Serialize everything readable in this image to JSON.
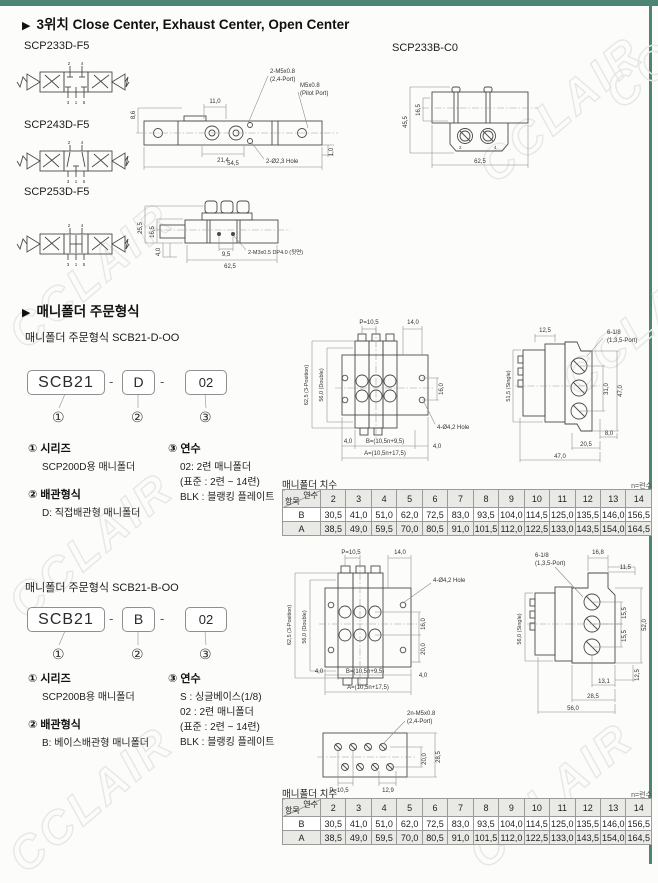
{
  "page": {
    "watermark": "CCLAIR",
    "bullet": "▶"
  },
  "section_valves": {
    "title": "3위치 Close Center, Exhaust Center, Open Center",
    "model_233d": "SCP233D-F5",
    "model_233b": "SCP233B-C0",
    "model_243d": "SCP243D-F5",
    "model_253d": "SCP253D-F5",
    "valve_ports": {
      "p2": "2",
      "p4": "4",
      "p3": "3",
      "p1": "1",
      "p5": "5"
    },
    "dwg233d": {
      "d110": "11,0",
      "d86": "8,6",
      "d214": "21,4",
      "d545": "54,5",
      "d10": "1,0",
      "c1": "2-M5x0.8",
      "c1b": "(2,4-Port)",
      "c2": "M5x0.8",
      "c2b": "(Pilot Port)",
      "c3": "2-Ø2,3 Hole"
    },
    "dwg233b": {
      "d455": "45,5",
      "d165": "16,5",
      "d625": "62,5",
      "p2": "2",
      "p4": "4"
    },
    "dwg253d": {
      "d255": "25,5",
      "d165": "16,5",
      "d40": "4,0",
      "d95": "9,5",
      "d625": "62,5",
      "c1": "2-M3x0.5 DP4.0 (뒷면)"
    }
  },
  "section_manifold": {
    "title": "매니폴더 주문형식",
    "form_d": {
      "subtitle": "매니폴더 주문형식 SCB21-D-OO",
      "code": {
        "part1": "SCB21",
        "sep1": "-",
        "part2": "D",
        "sep2": "-",
        "part3": "02",
        "mark1": "①",
        "mark2": "②",
        "mark3": "③"
      },
      "legend": {
        "series_title": "① 시리즈",
        "series_desc": "SCP200D용 매니폴더",
        "piping_title": "② 배관형식",
        "piping_desc": "D: 직접배관형 매니폴더",
        "units_title": "③ 연수",
        "units_lines": [
          "02: 2련 매니폴더",
          "(표준 : 2련 ~ 14련)",
          "BLK : 블랭킹 플레이트"
        ]
      },
      "drawing": {
        "top": {
          "p": "P=10,5",
          "d14": "14,0",
          "dpos": "62,5 (3-Position)",
          "ddbl": "56,0 (Double)",
          "d16": "16,0",
          "hole": "4-Ø4,2 Hole",
          "d4a": "4,0",
          "db": "B=(10,5n+9,5)",
          "d4b": "4,0",
          "da": "A=(10,5n+17,5)"
        },
        "side": {
          "port": "6-1/8",
          "port2": "(1,3,5-Port)",
          "d125": "12,5",
          "d31": "31,0",
          "d47": "47,0",
          "d8": "8,0",
          "d205": "20,5",
          "d47b": "47,0",
          "dsingle": "51,5 (Single)"
        }
      }
    },
    "form_b": {
      "subtitle": "매니폴더 주문형식 SCB21-B-OO",
      "code": {
        "part1": "SCB21",
        "sep1": "-",
        "part2": "B",
        "sep2": "-",
        "part3": "02",
        "mark1": "①",
        "mark2": "②",
        "mark3": "③"
      },
      "legend": {
        "series_title": "① 시리즈",
        "series_desc": "SCP200B용 매니폴더",
        "piping_title": "② 배관형식",
        "piping_desc": "B: 베이스배관형 매니폴더",
        "units_title": "③ 연수",
        "units_lines": [
          "S : 싱글베이스(1/8)",
          "02 : 2련 매니폴더",
          "(표준 : 2련 ~ 14련)",
          "BLK : 블랭킹 플레이트"
        ]
      },
      "drawing": {
        "top": {
          "p": "P=10,5",
          "d14": "14,0",
          "hole": "4-Ø4,2 Hole",
          "dpos": "62,5 (3-Position)",
          "ddbl": "56,0 (Double)",
          "d16": "16,0",
          "d20": "20,0",
          "d4a": "4,0",
          "db": "B=(10,5n+9,5)",
          "d4b": "4,0",
          "da": "A=(10,5n+17,5)"
        },
        "side": {
          "port": "6-1/8",
          "port2": "(1,3,5-Port)",
          "d168": "16,8",
          "d115": "11,5",
          "d155a": "15,5",
          "d155b": "15,5",
          "d52": "52,0",
          "d131": "13,1",
          "d125": "12,5",
          "d285": "28,5",
          "d56": "56,0",
          "dsingle": "56,0 (Single)"
        },
        "bottom": {
          "c1": "2n-M5x0.8",
          "c1b": "(2,4-Port)",
          "d20": "20,0",
          "d285": "28,5",
          "p": "P=10,5",
          "d129": "12,9"
        }
      }
    },
    "dim_table": {
      "caption": "매니폴더 치수",
      "note": "n=련수",
      "diag_top": "연수",
      "diag_bottom": "항목",
      "columns": [
        "2",
        "3",
        "4",
        "5",
        "6",
        "7",
        "8",
        "9",
        "10",
        "11",
        "12",
        "13",
        "14"
      ],
      "rows": [
        {
          "label": "B",
          "values": [
            "30,5",
            "41,0",
            "51,0",
            "62,0",
            "72,5",
            "83,0",
            "93,5",
            "104,0",
            "114,5",
            "125,0",
            "135,5",
            "146,0",
            "156,5"
          ]
        },
        {
          "label": "A",
          "values": [
            "38,5",
            "49,0",
            "59,5",
            "70,0",
            "80,5",
            "91,0",
            "101,5",
            "112,0",
            "122,5",
            "133,0",
            "143,5",
            "154,0",
            "164,5"
          ]
        }
      ]
    }
  }
}
